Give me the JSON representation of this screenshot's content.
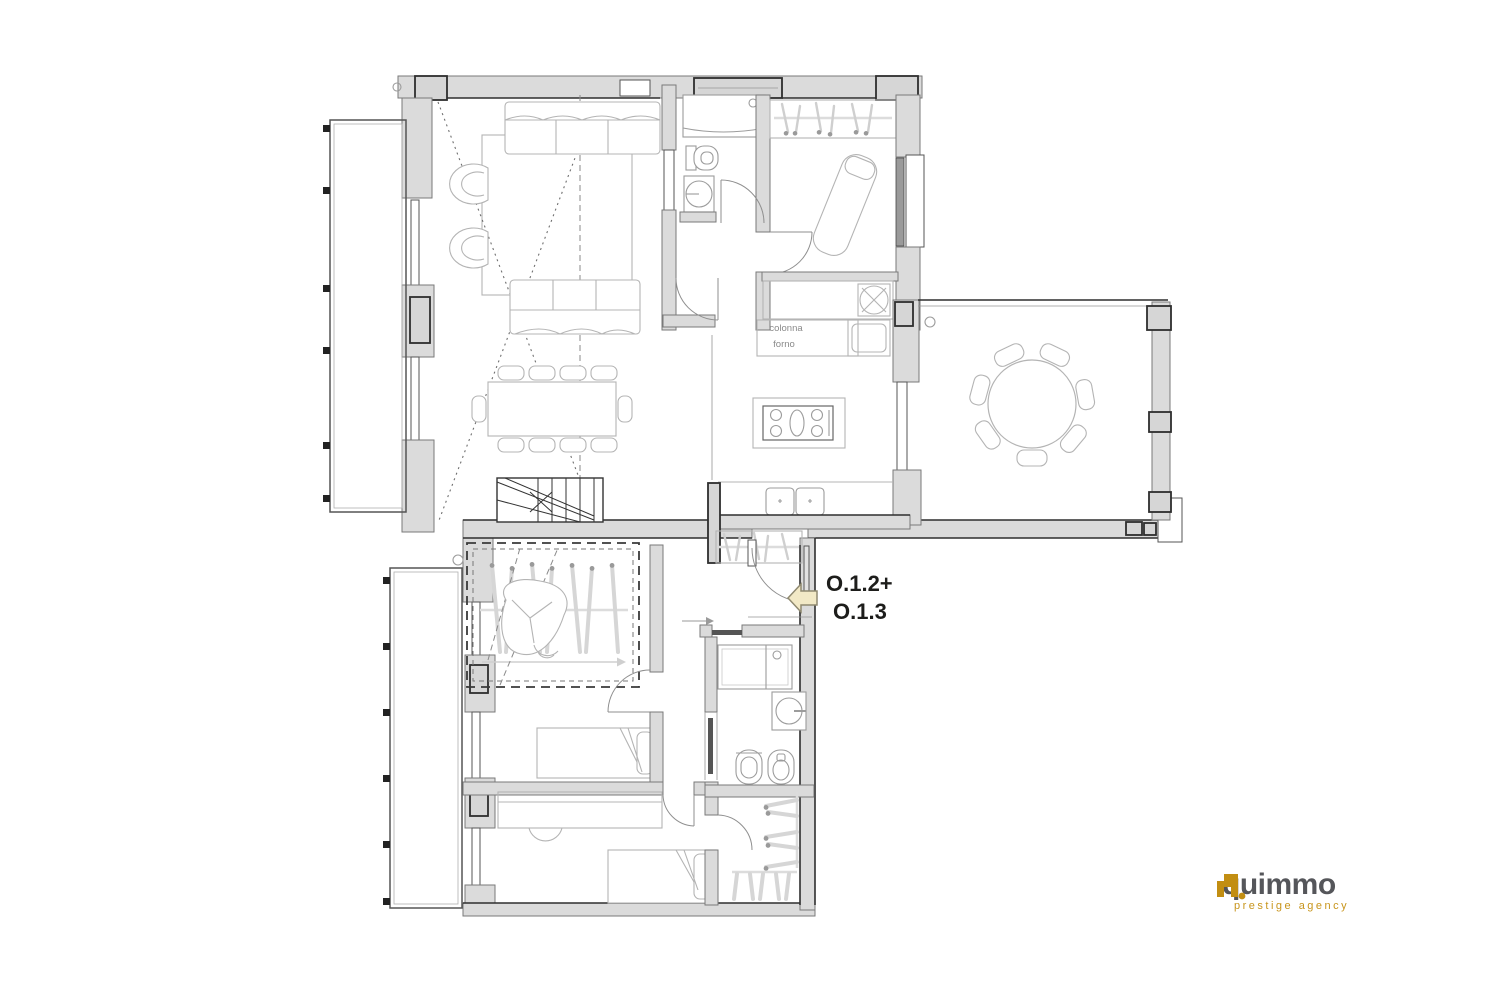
{
  "canvas": {
    "width": 1500,
    "height": 1000,
    "background": "#FFFFFF"
  },
  "floorplan": {
    "type": "apartment-floor-plan",
    "entrance": {
      "label_line1": "O.1.2+",
      "label_line2": "O.1.3",
      "arrow_direction": "left",
      "arrow_fill": "#F2E9C6",
      "arrow_stroke": "#8F8970",
      "label_color": "#1D1D1B"
    },
    "annotations": {
      "kitchen_column_line1": "colonna",
      "kitchen_column_line2": "forno",
      "note_color": "#8A8A8A"
    },
    "palette": {
      "wall_fill": "#DBDBDB",
      "wall_edge_dark": "#2E2E2E",
      "partition": "#7A7A7A",
      "furniture_line": "#B4B4B4",
      "fixture_line": "#9C9C9C",
      "stair_line": "#333333",
      "dashed_line": "#3A3A3A",
      "background": "#FFFFFF"
    },
    "rooms": [
      "living-room",
      "dining-area",
      "kitchen",
      "entrance-hall",
      "corridor",
      "bathroom-top",
      "bathroom-bottom",
      "bedroom-top-right",
      "bedroom-middle",
      "bedroom-bottom",
      "walk-in-closet",
      "staircase",
      "under-stair-wardrobe",
      "balcony-top-left",
      "balcony-bottom-left",
      "terrace-right"
    ]
  },
  "branding": {
    "logo_text": "quimmo",
    "tagline": "prestige agency",
    "logo_text_color": "#55565A",
    "brand_gold": "#C28E12"
  }
}
